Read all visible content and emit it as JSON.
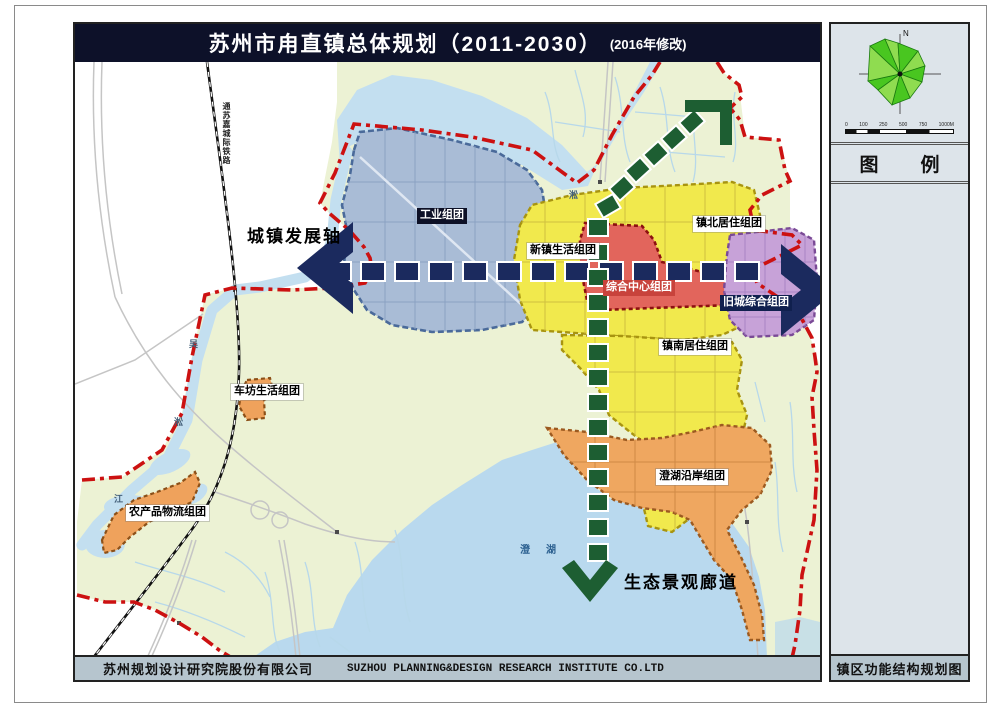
{
  "title": {
    "main": "苏州市甪直镇总体规划（2011-2030）",
    "suffix": "(2016年修改)"
  },
  "footer": {
    "credit_cn": "苏州规划设计研究院股份有限公司",
    "credit_en": "SUZHOU PLANNING&DESIGN RESEARCH INSTITUTE CO.LTD",
    "map_name": "镇区功能结构规划图"
  },
  "sidebar": {
    "north": "N",
    "legend": {
      "char1": "图",
      "char2": "例"
    },
    "scale_labels": [
      "0",
      "100",
      "250",
      "500",
      "750",
      "1000M"
    ]
  },
  "map": {
    "axis_label": "城镇发展轴",
    "corridor_label": "生态景观廊道",
    "railway_label": "通苏嘉城际铁路",
    "zones": {
      "industrial": "工业组团",
      "new_town_living": "新镇生活组团",
      "comprehensive_center": "综合中心组团",
      "north_residential": "镇北居住组团",
      "old_town": "旧城综合组团",
      "south_residential": "镇南居住组团",
      "chefang_living": "车坊生活组团",
      "agri_logistics": "农产品物流组团",
      "lakeside": "澄湖沿岸组团"
    },
    "water_labels": {
      "song_top": "淞",
      "wu": "吴",
      "song": "淞",
      "jiang": "江",
      "cheng": "澄",
      "hu": "湖"
    }
  },
  "colors": {
    "boundary_red": "#cc1111",
    "axis_navy": "#1b2a5e",
    "corridor_green": "#1d5e32",
    "industrial_blue": "#a9bcd6",
    "residential_yellow": "#f1e94d",
    "center_red": "#e2655c",
    "old_town_purple": "#c7a2d8",
    "cluster_orange": "#efa760",
    "water_blue": "#c3dff0",
    "land_green": "#ecf2d4"
  }
}
